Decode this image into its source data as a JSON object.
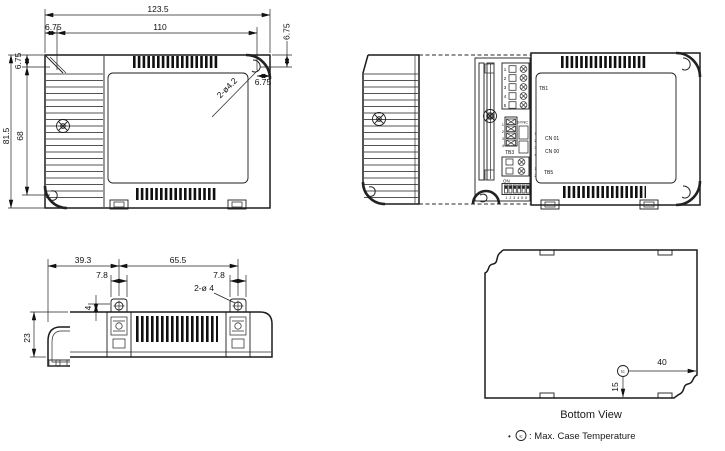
{
  "colors": {
    "line": "#1c1c1c",
    "green": "#2f9e44",
    "blue": "#3440c4",
    "red": "#d64545",
    "navy": "#1f3a5f"
  },
  "top_view": {
    "w_overall": "123.5",
    "w_offset": "6.75",
    "w_inner": "110",
    "h_offset_right": "6.75",
    "w_offset_right": "6.75",
    "h_offset_left": "6.75",
    "h_overall": "81.5",
    "h_inner": "68",
    "holes": "2-ø4.2"
  },
  "open_view": {
    "tb1": "TB1",
    "tb3": "TB3",
    "tb5": "TB5",
    "sync": "SYNC",
    "cn01": "CN 01",
    "cn00": "CN 00",
    "dip_on": "ON",
    "dip_nums": "1 2 3 4 5 6",
    "block_pins": [
      "1",
      "2",
      "3",
      "4",
      "5"
    ],
    "tb3_pins": [
      "1",
      "2",
      "3",
      "4"
    ],
    "cn_pins": [
      "1",
      "2",
      "3",
      "4"
    ],
    "tb5_pins": [
      "1",
      "2"
    ]
  },
  "side_view": {
    "l_offset": "39.3",
    "span": "65.5",
    "tab_l": "7.8",
    "tab_r": "7.8",
    "hole_off": "4",
    "holes": "2-ø 4",
    "height": "23"
  },
  "bottom_view": {
    "caption": "Bottom View",
    "tc": "tc",
    "d_right": "40",
    "d_bottom": "15"
  },
  "note": {
    "bullet": "•",
    "tc": "tc",
    "text": ": Max. Case Temperature"
  }
}
